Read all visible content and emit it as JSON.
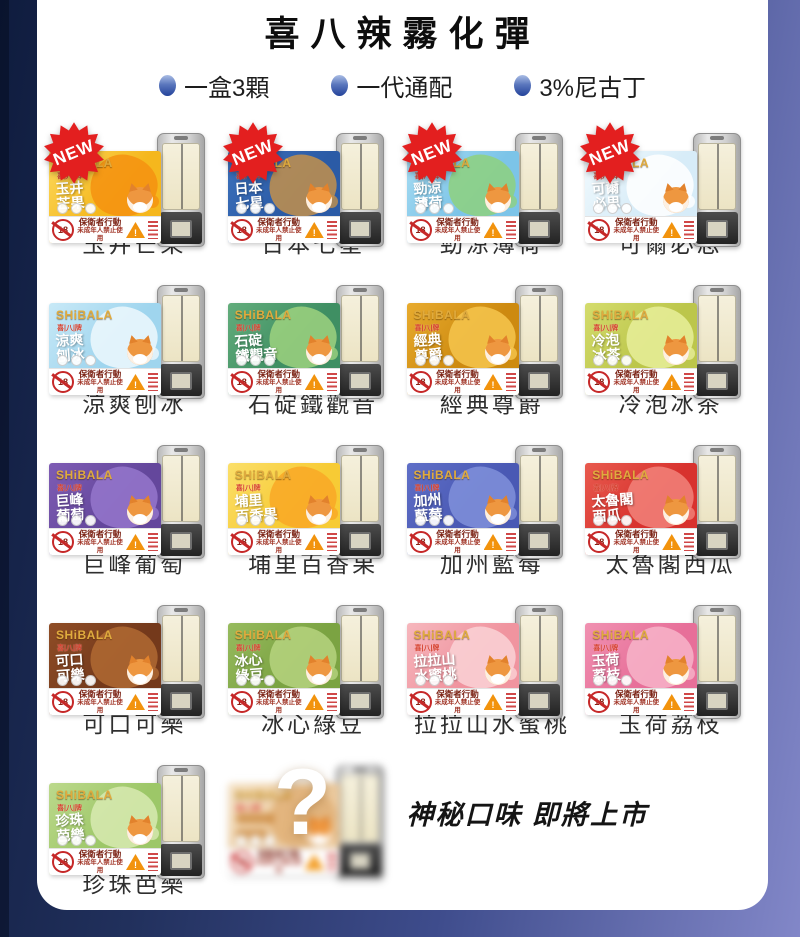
{
  "page": {
    "title": "喜八辣霧化彈",
    "bullets": [
      {
        "label": "一盒3顆"
      },
      {
        "label": "一代通配"
      },
      {
        "label": "3%尼古丁"
      }
    ]
  },
  "card_common": {
    "brand": "SHiBALA",
    "brand_sub": "喜|八|牌",
    "new_label": "NEW",
    "age_label": "18",
    "warning_title": "保衛者行動",
    "warning_sub": "未成年人禁止使用",
    "warning_mark": "!"
  },
  "products": [
    {
      "name": "玉井芒果",
      "is_new": true,
      "art1": "玉井",
      "art2": "芒果",
      "c1": "#f5b71d",
      "c2": "#fcd95d",
      "acc": "#f59210"
    },
    {
      "name": "日本七星",
      "is_new": true,
      "art1": "日本",
      "art2": "七星",
      "c1": "#2b5ba6",
      "c2": "#3d72bd",
      "acc": "#c3914b"
    },
    {
      "name": "勁涼薄荷",
      "is_new": true,
      "art1": "勁涼",
      "art2": "薄荷",
      "c1": "#7cc4e8",
      "c2": "#a8dcf2",
      "acc": "#8ed17e"
    },
    {
      "name": "可爾必思",
      "is_new": true,
      "art1": "可爾",
      "art2": "必思",
      "c1": "#d7ecf8",
      "c2": "#f2fafd",
      "acc": "#ffffff"
    },
    {
      "name": "涼爽刨冰",
      "is_new": false,
      "art1": "涼爽",
      "art2": "刨冰",
      "c1": "#9fd5ee",
      "c2": "#c8e9f7",
      "acc": "#edf8fd"
    },
    {
      "name": "石碇鐵觀音",
      "is_new": false,
      "art1": "石碇",
      "art2": "鐵觀音",
      "c1": "#3f8f63",
      "c2": "#63ad7c",
      "acc": "#9ed27f"
    },
    {
      "name": "經典尊爵",
      "is_new": false,
      "art1": "經典",
      "art2": "尊爵",
      "c1": "#cd8a10",
      "c2": "#e8ab2e",
      "acc": "#f6c54e"
    },
    {
      "name": "冷泡冰茶",
      "is_new": false,
      "art1": "冷泡",
      "art2": "冰茶",
      "c1": "#bcc64b",
      "c2": "#d4dc6d",
      "acc": "#e7ee9a"
    },
    {
      "name": "巨峰葡萄",
      "is_new": false,
      "art1": "巨峰",
      "art2": "葡萄",
      "c1": "#64479c",
      "c2": "#7e5cb4",
      "acc": "#9577cc"
    },
    {
      "name": "埔里百香果",
      "is_new": false,
      "art1": "埔里",
      "art2": "百香果",
      "c1": "#f7cb35",
      "c2": "#fbdf6a",
      "acc": "#f9a826"
    },
    {
      "name": "加州藍莓",
      "is_new": false,
      "art1": "加州",
      "art2": "藍莓",
      "c1": "#4a59b4",
      "c2": "#5f6fc7",
      "acc": "#8090da"
    },
    {
      "name": "太魯閣西瓜",
      "is_new": false,
      "art1": "太魯閣",
      "art2": "西瓜",
      "c1": "#d8322e",
      "c2": "#e85a4e",
      "acc": "#f2837a"
    },
    {
      "name": "可口可樂",
      "is_new": false,
      "art1": "可口",
      "art2": "可樂",
      "c1": "#74391b",
      "c2": "#8f4d26",
      "acc": "#b06a33"
    },
    {
      "name": "冰心綠豆",
      "is_new": false,
      "art1": "冰心",
      "art2": "綠豆",
      "c1": "#7ba342",
      "c2": "#97bb5e",
      "acc": "#b6d37f"
    },
    {
      "name": "拉拉山水蜜桃",
      "is_new": false,
      "art1": "拉拉山",
      "art2": "水蜜桃",
      "c1": "#f0949f",
      "c2": "#f6b7bd",
      "acc": "#fad2d6"
    },
    {
      "name": "玉荷荔枝",
      "is_new": false,
      "art1": "玉荷",
      "art2": "荔枝",
      "c1": "#e76f99",
      "c2": "#f091b1",
      "acc": "#f7b4c9"
    },
    {
      "name": "珍珠芭樂",
      "is_new": false,
      "art1": "珍珠",
      "art2": "芭樂",
      "c1": "#9dc768",
      "c2": "#bcd98c",
      "acc": "#d8eab2"
    }
  ],
  "mystery": {
    "question_mark": "?",
    "announce": "神秘口味 即將上市",
    "box": {
      "c1": "#ecca9e",
      "c2": "#f5e3c8",
      "acc": "#e0b077"
    }
  },
  "colors": {
    "badge_red": "#e31f1f",
    "panel_white": "#ffffff",
    "bg_navy": "#0f1c3e",
    "bg_periwinkle": "#8287c8",
    "bullet_blue": "#24439a"
  }
}
